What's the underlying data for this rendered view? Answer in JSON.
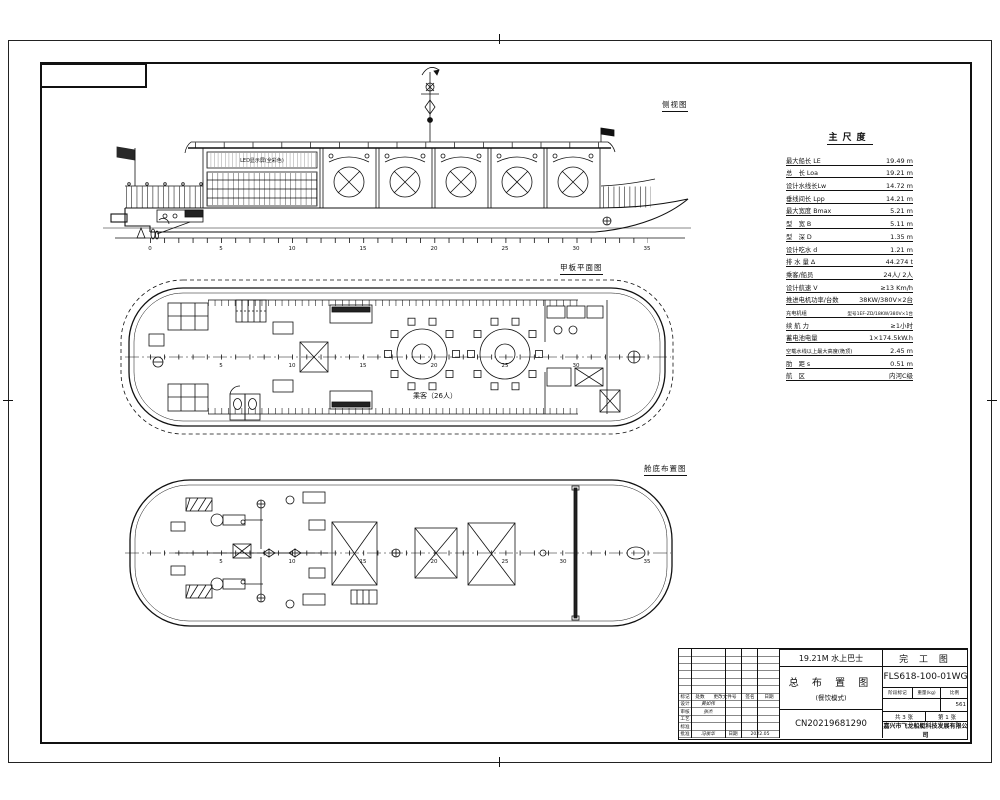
{
  "drawing": {
    "view_labels": {
      "side": "侧视图",
      "deck": "甲板平面图",
      "bilge": "舱底布置图"
    },
    "annotations": {
      "led_screen": "LED显示屏(全彩色)",
      "deck_capacity": "乘客（26人）"
    },
    "frame_numbers": [
      "0",
      "5",
      "10",
      "15",
      "20",
      "25",
      "30",
      "35"
    ]
  },
  "spec_table": {
    "title": "主尺度",
    "rows": [
      {
        "label": "最大船长 LE",
        "value": "19.49 m"
      },
      {
        "label": "总　长 Loa",
        "value": "19.21 m"
      },
      {
        "label": "设计水线长Lw",
        "value": "14.72 m"
      },
      {
        "label": "垂线间长 Lpp",
        "value": "14.21 m"
      },
      {
        "label": "最大宽度 Bmax",
        "value": "5.21 m"
      },
      {
        "label": "型　宽 B",
        "value": "5.11 m"
      },
      {
        "label": "型　深 D",
        "value": "1.35 m"
      },
      {
        "label": "设计吃水 d",
        "value": "1.21 m"
      },
      {
        "label": "排 水 量 Δ",
        "value": "44.274 t"
      },
      {
        "label": "乘客/船员",
        "value": "24人/ 2人"
      },
      {
        "label": "设计航速 V",
        "value": "≥13 Km/h"
      },
      {
        "label": "推进电机功率/台数",
        "value": "38KW/380V×2台"
      },
      {
        "label": "充电机组",
        "value": "型号1EF-ZD/18KW/380V×1台"
      },
      {
        "label": "续 航 力",
        "value": "≥1小时"
      },
      {
        "label": "蓄电池电量",
        "value": "1×174.5kW.h"
      },
      {
        "label": "空载水线以上最大高度(桅顶)",
        "value": "2.45 m"
      },
      {
        "label": "肋　距 s",
        "value": "0.51 m"
      },
      {
        "label": "航　区",
        "value": "内河C级"
      }
    ]
  },
  "title_block": {
    "project": "19.21M 水上巴士",
    "stage": "完 工 图",
    "drawing_no": "FLS618-100-01WG",
    "title": "总 布 置 图",
    "subtitle": "(餐饮模式)",
    "serial": "CN20219681290",
    "company": "嘉兴市飞龙船艇科技发展有限公司",
    "header": {
      "mark": "标记",
      "count": "处数",
      "doc_no": "更改文件号",
      "sign": "签名",
      "date": "日期"
    },
    "rows": [
      {
        "role": "设计",
        "name": "黄如伟"
      },
      {
        "role": "审核",
        "name": "张杰"
      },
      {
        "role": "工艺",
        "name": ""
      },
      {
        "role": "标准",
        "name": ""
      },
      {
        "role": "批准",
        "name": "冯俊华"
      }
    ],
    "date_label": "日期",
    "approve_date": "2022.05",
    "stage_header": {
      "stage_mark": "阶段标记",
      "weight": "重量(kg)",
      "scale": "比例"
    },
    "scale_value": "561",
    "sheets": {
      "total": "共 3 张",
      "page": "第 1 张"
    }
  }
}
